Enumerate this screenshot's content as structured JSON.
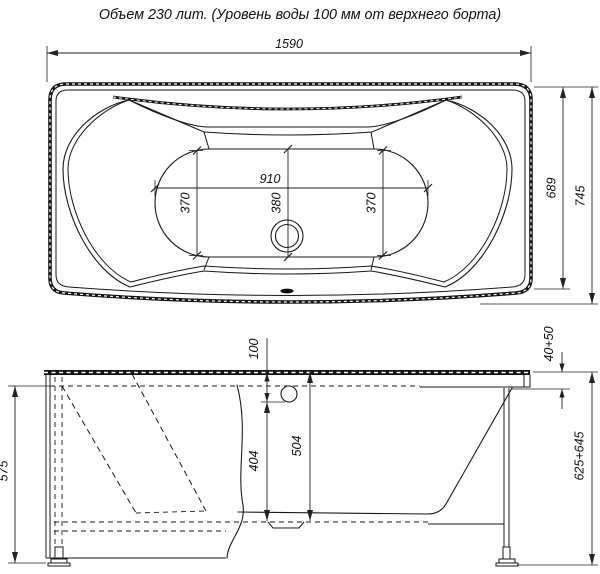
{
  "title": "Объем 230 лит. (Уровень воды 100 мм от верхнего борта)",
  "drawing": {
    "colors": {
      "line": "#1a1a1a",
      "dimension": "#222222",
      "background": "#ffffff"
    },
    "views": {
      "top_view": {
        "dimensions": {
          "overall_length": "1590",
          "bottom_length": "910",
          "bottom_width_left": "370",
          "bottom_width_center": "380",
          "bottom_width_right": "370",
          "rim_width": "689",
          "overall_width": "745"
        }
      },
      "side_view": {
        "dimensions": {
          "water_level_from_rim": "100",
          "depth_below_water_level": "404",
          "inner_depth": "504",
          "panel_height": "575",
          "rim_drop_range": "40+50",
          "overall_height_range": "625+645"
        }
      }
    }
  }
}
